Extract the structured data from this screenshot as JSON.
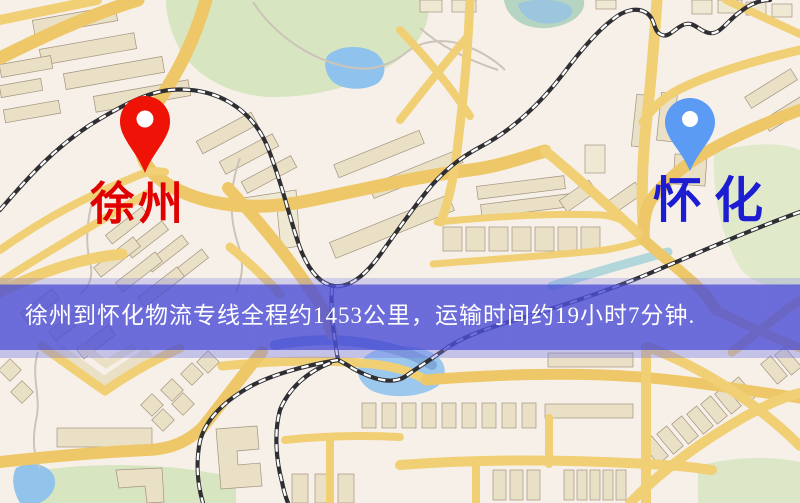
{
  "window": {
    "width": 800,
    "height": 503,
    "kind": "logistics-route-map-image"
  },
  "map": {
    "markers": [
      {
        "name": "origin",
        "label": "徐州",
        "label_color": "#e00000",
        "pin_color": "#ee1306",
        "pin_icon": "red-location-pin-icon"
      },
      {
        "name": "destination",
        "label": "怀化",
        "label_color": "#1c1cd2",
        "pin_color": "#5b9bf3",
        "pin_icon": "blue-location-pin-icon"
      }
    ],
    "banner": {
      "text": "徐州到怀化物流专线全程约1453公里，运输时间约19小时7分钟.",
      "bg_color": "#4d4fd6",
      "text_color": "#ffffff"
    },
    "colors": {
      "background": "#f7f0e9",
      "road": "#f1cf74",
      "park": "#d7e5c1",
      "water": "#92c3ea",
      "railway": "#2f2f33",
      "building": "#e9e0c6"
    }
  }
}
